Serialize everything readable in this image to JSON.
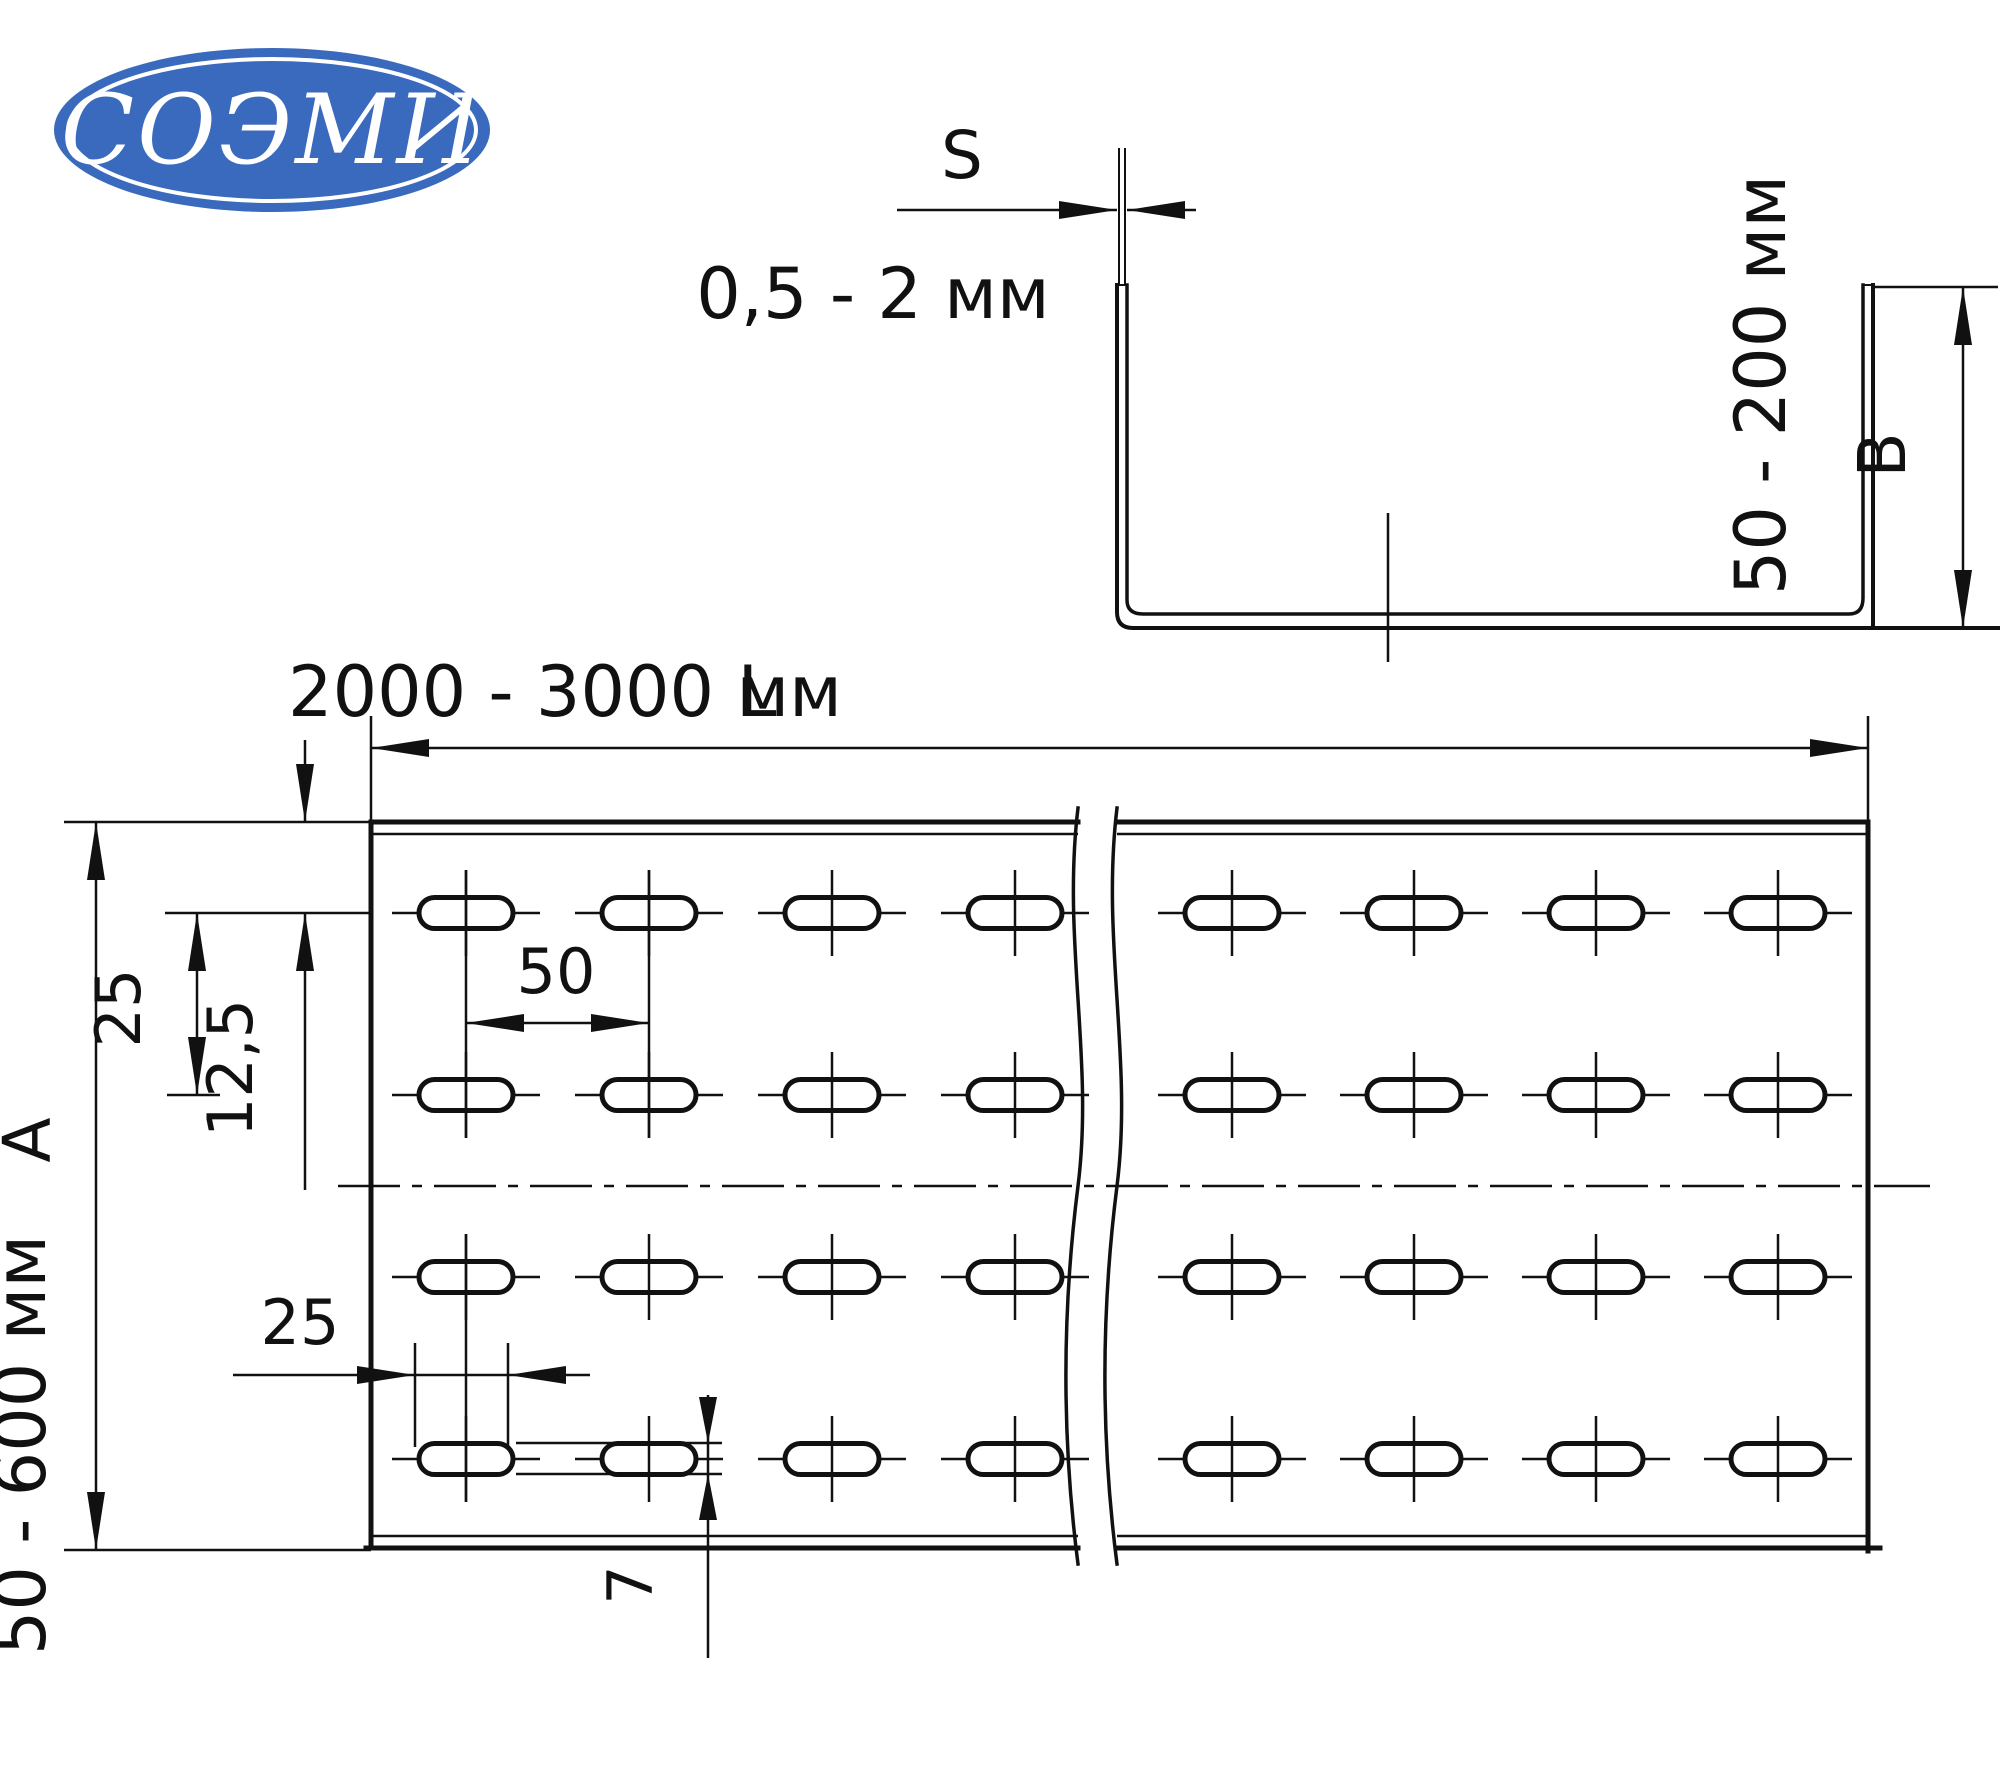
{
  "logo": {
    "text": "СОЭМИ",
    "bg_color": "#3a6abd"
  },
  "section_view": {
    "thickness_label": "S",
    "thickness_range": "0,5 - 2 мм",
    "height_range": "50 - 200 мм",
    "height_label": "B"
  },
  "plan_view": {
    "length_range": "2000 - 3000 мм",
    "length_label": "L",
    "width_range": "50 - 600 мм",
    "width_label": "А",
    "edge_to_row_offset": "12,5",
    "row_pitch": "25",
    "slot_pitch": "50",
    "slot_length": "25",
    "slot_width": "7"
  }
}
